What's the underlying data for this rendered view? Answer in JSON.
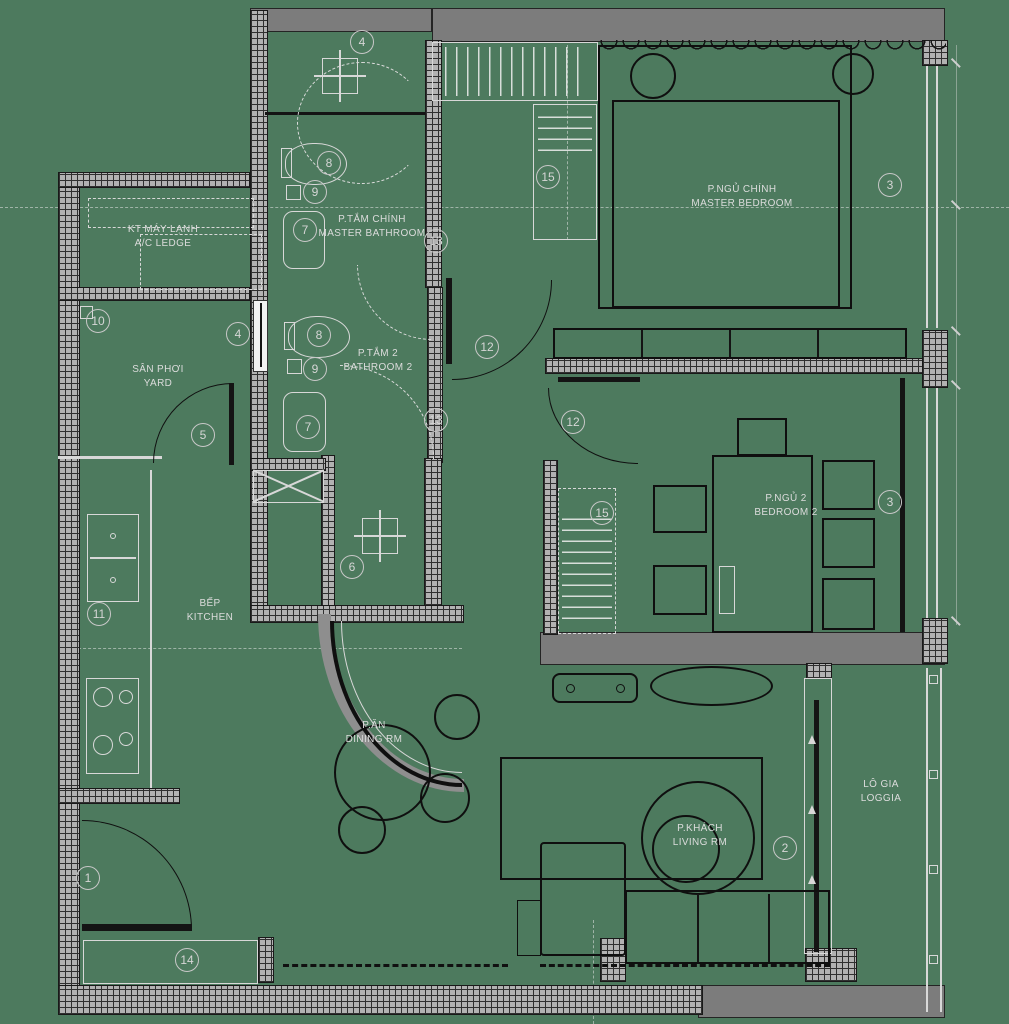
{
  "plan_colors": {
    "background": "#4d7a5e",
    "wall_gray": "#7c7c7c",
    "line_light": "#d8d8d8",
    "line_dark": "#101010"
  },
  "rooms": {
    "master_bedroom": {
      "vi": "P.NGỦ CHÍNH",
      "en": "MASTER BEDROOM"
    },
    "master_bathroom": {
      "vi": "P.TẮM CHÍNH",
      "en": "MASTER BATHROOM"
    },
    "bathroom2": {
      "vi": "P.TẮM 2",
      "en": "BATHROOM 2"
    },
    "bedroom2": {
      "vi": "P.NGỦ 2",
      "en": "BEDROOM 2"
    },
    "yard": {
      "vi": "SÂN PHƠI",
      "en": "YARD"
    },
    "ac_ledge": {
      "vi": "KT MÁY LẠNH",
      "en": "A/C LEDGE"
    },
    "kitchen": {
      "vi": "BẾP",
      "en": "KITCHEN"
    },
    "dining": {
      "vi": "P.ĂN",
      "en": "DINING RM"
    },
    "living": {
      "vi": "P.KHÁCH",
      "en": "LIVING RM"
    },
    "loggia": {
      "vi": "LÔ GIA",
      "en": "LOGGIA"
    }
  },
  "markers": {
    "1": "1",
    "2": "2",
    "3": "3",
    "4": "4",
    "5": "5",
    "6": "6",
    "7": "7",
    "8": "8",
    "9": "9",
    "10": "10",
    "11": "11",
    "12": "12",
    "13": "13",
    "14": "14",
    "15": "15"
  }
}
